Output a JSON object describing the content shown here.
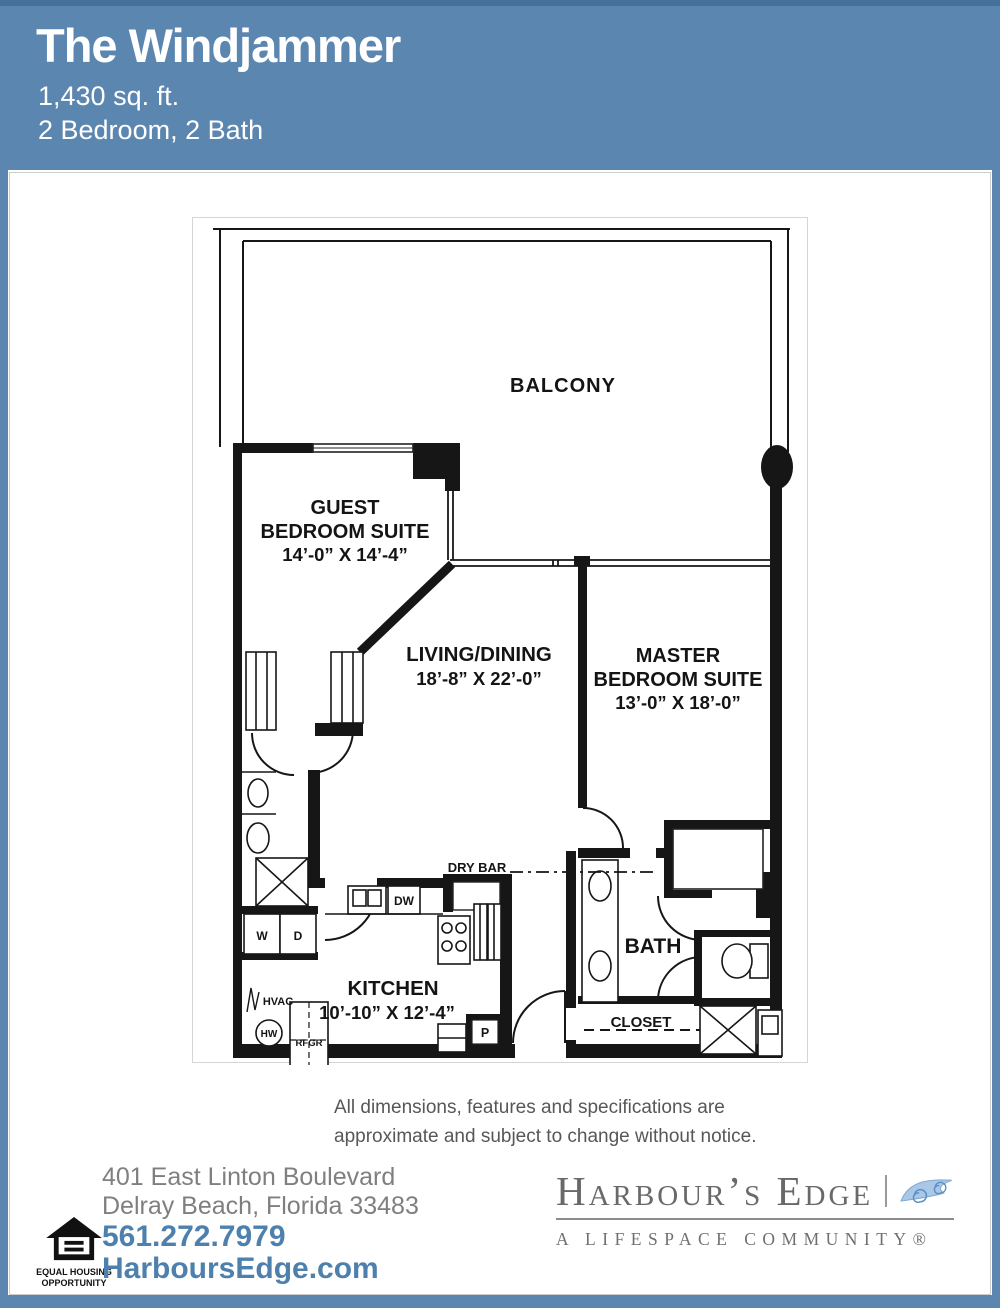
{
  "header": {
    "title": "The Windjammer",
    "area": "1,430 sq. ft.",
    "config": "2 Bedroom, 2 Bath"
  },
  "floor_plan": {
    "balcony": "BALCONY",
    "guest_bedroom": {
      "line1": "GUEST",
      "line2": "BEDROOM SUITE",
      "dims": "14’-0” X 14’-4”"
    },
    "living_dining": {
      "line1": "LIVING/DINING",
      "dims": "18’-8” X 22’-0”"
    },
    "master_bedroom": {
      "line1": "MASTER",
      "line2": "BEDROOM SUITE",
      "dims": "13’-0” X 18’-0”"
    },
    "kitchen": {
      "line1": "KITCHEN",
      "dims": "10’-10” X 12’-4”"
    },
    "bath": "BATH",
    "closet": "CLOSET",
    "dry_bar": "DRY BAR",
    "appliances": {
      "dishwasher": "DW",
      "washer": "W",
      "dryer": "D",
      "hvac": "HVAC",
      "water_heater": "HW",
      "refrigerator": "RFGR",
      "pantry": "P"
    }
  },
  "disclaimer": {
    "line1": "All dimensions, features and specifications are",
    "line2": "approximate and subject to change without notice."
  },
  "footer": {
    "address_line1": "401 East Linton Boulevard",
    "address_line2": "Delray Beach, Florida 33483",
    "phone": "561.272.7979",
    "website": "HarboursEdge.com",
    "equal_housing": {
      "line1": "EQUAL HOUSING",
      "line2": "OPPORTUNITY"
    },
    "brand": {
      "name": "Harbour’s Edge",
      "tagline": "A LIFESPACE COMMUNITY®"
    }
  },
  "colors": {
    "header_blue": "#5b86b0",
    "top_edge_blue": "#44709c",
    "link_blue": "#4d80ad",
    "logo_gray": "#696969",
    "wave_blue": "#8fb4d9",
    "plan_line": "#161616"
  }
}
